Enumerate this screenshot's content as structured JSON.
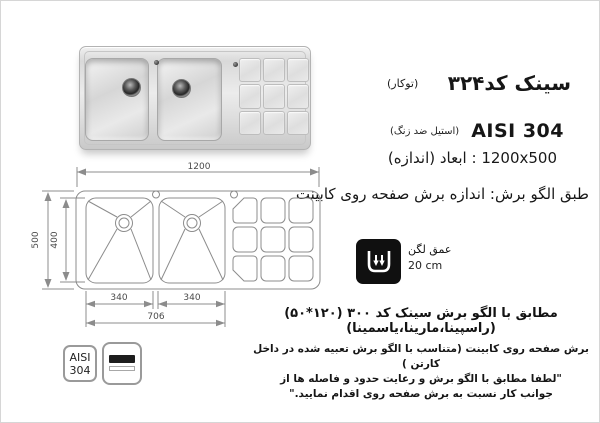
{
  "colors": {
    "ink": "#161616",
    "drawing_line": "#8c8c8c",
    "dimension_text": "#4a4a4a",
    "depth_icon_bg": "#101010",
    "page_border": "#d6d6d6"
  },
  "header": {
    "title": "سینک کد۳۲۴",
    "title_note": "(توکار)",
    "material": "AISI 304",
    "material_note": "(استیل ضد زنگ)",
    "size_line": "1200x500 : ابعاد (اندازه)",
    "pattern_line": "طبق الگو برش: اندازه برش صفحه روی کابینت"
  },
  "drawing": {
    "dim_width": "1200",
    "dim_height_outer": "500",
    "dim_height_inner": "400",
    "dim_bowl_left": "340",
    "dim_bowl_right": "340",
    "dim_bowls_total": "706"
  },
  "depth_badge": {
    "label": "عمق لگن",
    "value": "20 cm"
  },
  "notes": {
    "line1": "مطابق با الگو برش سینک کد ۳۰۰ (۱۲۰*۵۰)(راسپینا،مارینا،یاسمینا)",
    "line2": "برش صفحه روی کابینت (متناسب با الگو برش تعبیه شده در داخل کارتن )",
    "line3": "\"لطفا مطابق با الگو برش و رعایت حدود و فاصله ها از",
    "line4": "جوانب کار نسبت به برش صفحه روی اقدام نمایید.\""
  },
  "steel_badge": {
    "line1": "AISI",
    "line2": "304"
  }
}
